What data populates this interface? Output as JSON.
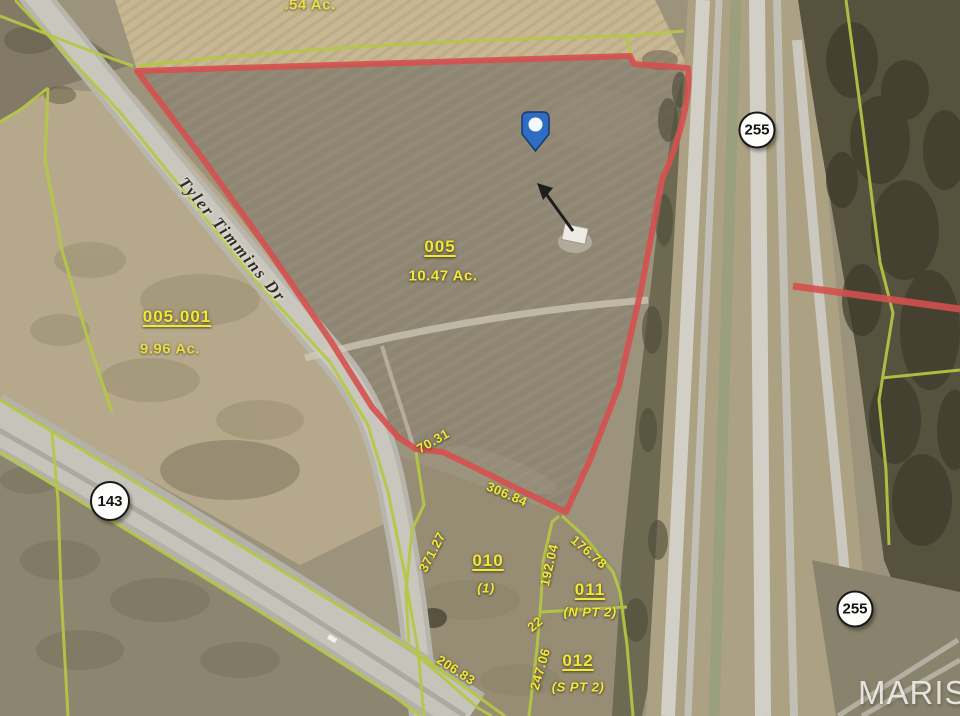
{
  "map": {
    "watermark": "MARIS",
    "top_parcel": {
      "acreage": ".54 Ac."
    },
    "roads": {
      "tyler_timmins": "Tyler Timmins Dr",
      "shield_143": "143",
      "shield_255_north": "255",
      "shield_255_south": "255"
    },
    "parcels": {
      "p005": {
        "id": "005",
        "acreage": "10.47 Ac."
      },
      "p005_001": {
        "id": "005.001",
        "acreage": "9.96 Ac."
      },
      "p010": {
        "id": "010",
        "note": "(1)"
      },
      "p011": {
        "id": "011",
        "note": "(N PT 2)"
      },
      "p012": {
        "id": "012",
        "note": "(S PT 2)"
      }
    },
    "dimensions": {
      "d70_31": "70.31",
      "d306_84": "306.84",
      "d371_27": "371.27",
      "d192_04": "192.04",
      "d176_78": "176.78",
      "d22": "22",
      "d247_06": "247.06",
      "d206_83": "206.83"
    },
    "colors": {
      "boundary_red": "#d5504e",
      "parcel_line_yellow": "#b5c844",
      "label_yellow": "#f2e838"
    }
  }
}
